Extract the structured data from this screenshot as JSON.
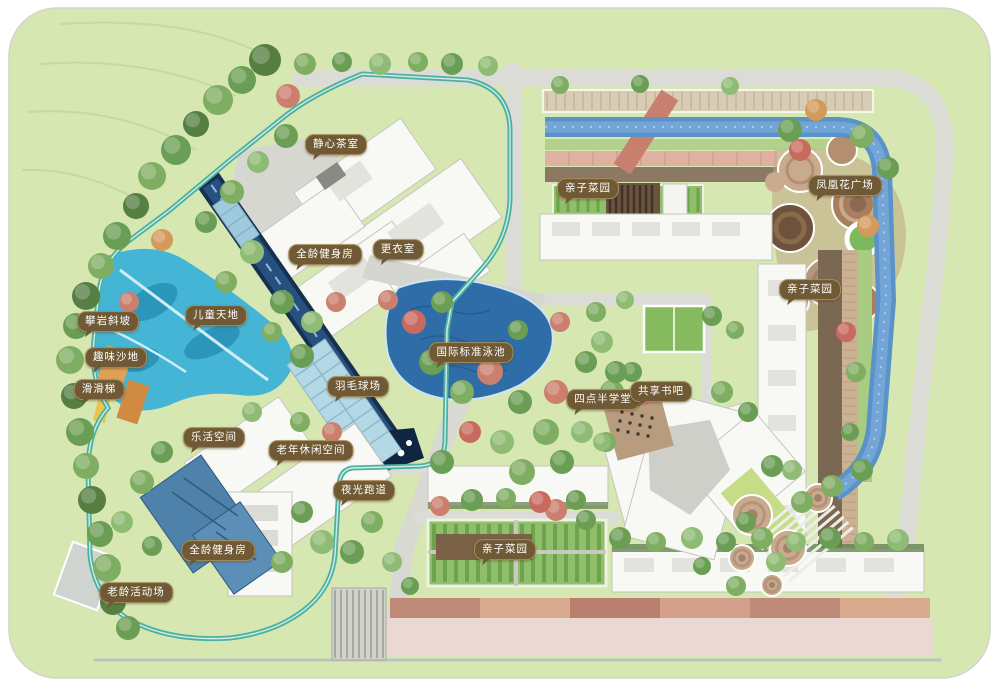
{
  "page": {
    "background": "#ffffff",
    "title": "residential landscape master plan"
  },
  "map": {
    "canvas_color": "#d6e7b2",
    "label_style": {
      "bg": "#6f5a35",
      "border": "#a78d5c",
      "text_color": "#ffffff"
    },
    "colors": {
      "lawn": "#d6e7b2",
      "road": "#dcdcd6",
      "stream_water": "#5b93c9",
      "pool_water": "#2e6da8",
      "lap_canal": "#16314f",
      "glow_track": "#4fb0a0",
      "playground": "#45b5d6",
      "plaza_paving": "#c3a683",
      "garden_green": "#8fbf6a",
      "paving_pink": "#dfae9e",
      "building": "#f8f8f4",
      "gym_blue": "#4e82ab",
      "sand_orange": "#e0a055"
    },
    "labels": [
      {
        "text": "静心茶室",
        "x": 336,
        "y": 146
      },
      {
        "text": "全龄健身房",
        "x": 325,
        "y": 256
      },
      {
        "text": "更衣室",
        "x": 398,
        "y": 251
      },
      {
        "text": "攀岩斜坡",
        "x": 108,
        "y": 323
      },
      {
        "text": "儿童天地",
        "x": 216,
        "y": 317
      },
      {
        "text": "趣味沙地",
        "x": 116,
        "y": 359
      },
      {
        "text": "滑滑梯",
        "x": 99,
        "y": 391
      },
      {
        "text": "国际标准泳池",
        "x": 471,
        "y": 354
      },
      {
        "text": "羽毛球场",
        "x": 358,
        "y": 388
      },
      {
        "text": "乐活空间",
        "x": 214,
        "y": 439
      },
      {
        "text": "老年休闲空间",
        "x": 311,
        "y": 452
      },
      {
        "text": "夜光跑道",
        "x": 364,
        "y": 492
      },
      {
        "text": "全龄健身房",
        "x": 218,
        "y": 552
      },
      {
        "text": "老龄活动场",
        "x": 136,
        "y": 594
      },
      {
        "text": "四点半学堂",
        "x": 603,
        "y": 401
      },
      {
        "text": "共享书吧",
        "x": 661,
        "y": 393
      },
      {
        "text": "亲子菜园",
        "x": 588,
        "y": 190
      },
      {
        "text": "凤凰花广场",
        "x": 845,
        "y": 187
      },
      {
        "text": "亲子菜园",
        "x": 810,
        "y": 291
      },
      {
        "text": "亲子菜园",
        "x": 505,
        "y": 551
      }
    ]
  }
}
